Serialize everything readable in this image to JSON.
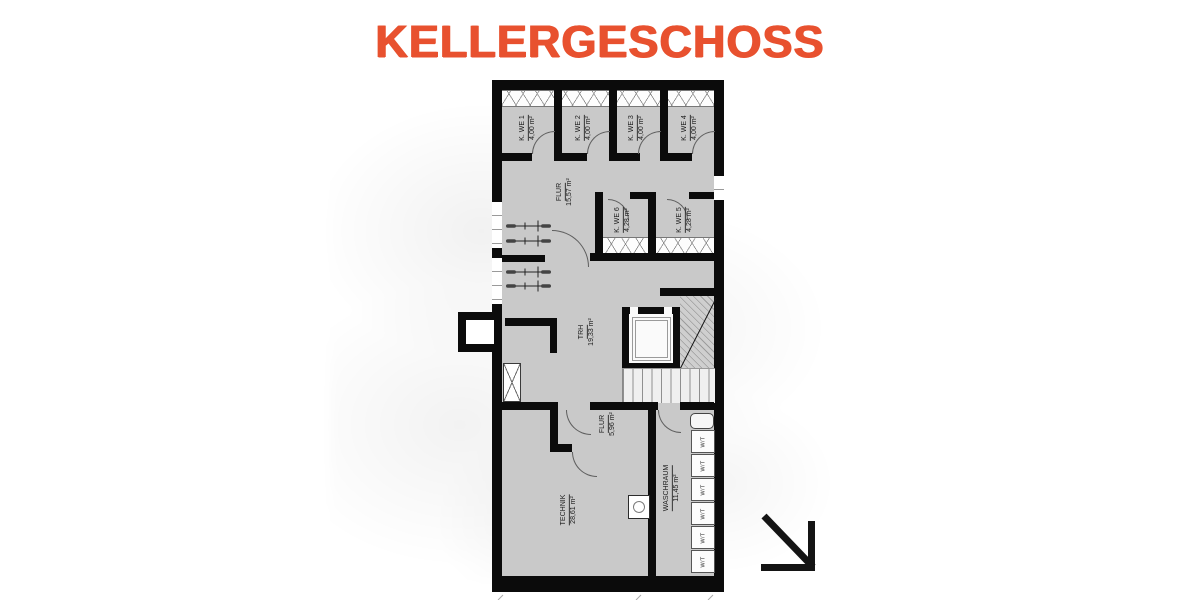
{
  "title": "KELLERGESCHOSS",
  "colors": {
    "accent": "#E8512F",
    "wall": "#0B0B0B",
    "floor": "#C9C9C9"
  },
  "rooms": [
    {
      "name": "K. WE 1",
      "area": "4,00 m²"
    },
    {
      "name": "K. WE 2",
      "area": "4,00 m²"
    },
    {
      "name": "K. WE 3",
      "area": "4,00 m²"
    },
    {
      "name": "K. WE 4",
      "area": "4,00 m²"
    },
    {
      "name": "FLUR",
      "area": "15,57 m²"
    },
    {
      "name": "K. WE 6",
      "area": "4,28 m²"
    },
    {
      "name": "K. WE 5",
      "area": "4,28 m²"
    },
    {
      "name": "TRH",
      "area": "19,33 m²"
    },
    {
      "name": "FLUR",
      "area": "5,96 m²"
    },
    {
      "name": "TECHNIK",
      "area": "28,61 m²"
    },
    {
      "name": "WASCHRAUM",
      "area": "11,45 m²"
    }
  ],
  "appliances": {
    "label": "W/T",
    "count": 6
  },
  "icons": {
    "direction_arrow": "↘",
    "bicycle": "top-view bicycle symbol"
  }
}
